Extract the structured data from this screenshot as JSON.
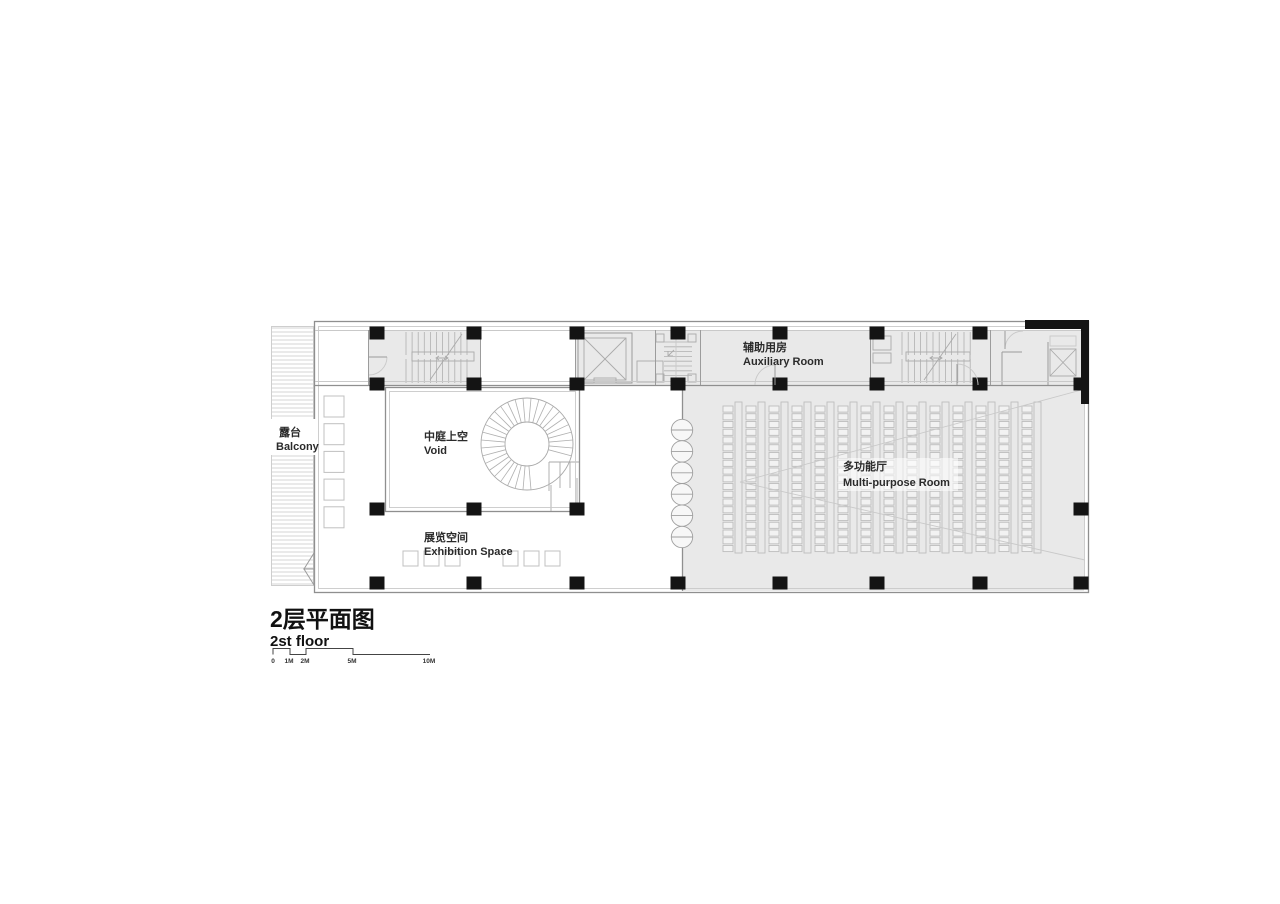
{
  "title": {
    "zh": "2层平面图",
    "en": "2st floor"
  },
  "scale_bar": {
    "labels": [
      "0",
      "1M",
      "2M",
      "5M",
      "10M"
    ]
  },
  "rooms": {
    "balcony": {
      "zh": "露台",
      "en": "Balcony"
    },
    "void": {
      "zh": "中庭上空",
      "en": "Void"
    },
    "exhibition": {
      "zh": "展览空间",
      "en": "Exhibition Space"
    },
    "auxiliary": {
      "zh": "辅助用房",
      "en": "Auxiliary Room"
    },
    "multipurpose": {
      "zh": "多功能厅",
      "en": "Multi-purpose Room"
    }
  },
  "plan": {
    "seat_columns": 14,
    "seats_per_column": 19,
    "door_circles": 6,
    "pedestal_squares": 5,
    "exhibit_squares": 6,
    "spiral_treads": 30,
    "balcony_hatch_pitch": 4
  },
  "colors": {
    "paper": "#ffffff",
    "room_fill": "#e9e9e9",
    "wall": "#8f8f8f",
    "light_line": "#c9c9c9",
    "hatch": "#d6d6d6",
    "seat_line": "#bdbdbd",
    "column": "#141414",
    "text": "#2b2b2b"
  }
}
